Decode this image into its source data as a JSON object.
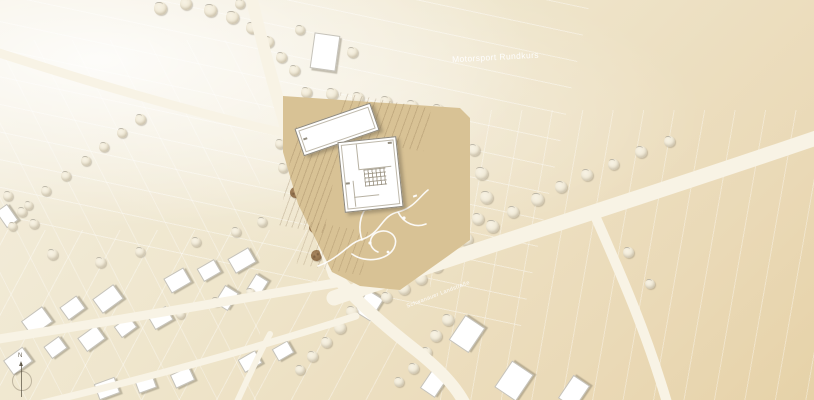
{
  "labels": {
    "area": "Motorsport Rundkurs",
    "street": "Schwanauer Landstraße",
    "north": "N"
  },
  "colors": {
    "background": "#efe7d0",
    "road": "#f8f3e5",
    "site": "#d8c295",
    "tree_dark": "#916f4a",
    "tree_light": "#f3edde",
    "house": "#ffffff",
    "shadow": "#8b8371",
    "label_text": "#ffffff"
  },
  "map": {
    "light_trees": [
      [
        160,
        8,
        13
      ],
      [
        186,
        4,
        12
      ],
      [
        210,
        10,
        13
      ],
      [
        232,
        17,
        13
      ],
      [
        252,
        28,
        12
      ],
      [
        268,
        42,
        12
      ],
      [
        281,
        57,
        11
      ],
      [
        240,
        4,
        10
      ],
      [
        294,
        70,
        11
      ],
      [
        300,
        30,
        10
      ],
      [
        352,
        52,
        11
      ],
      [
        140,
        119,
        11
      ],
      [
        122,
        133,
        10
      ],
      [
        104,
        147,
        10
      ],
      [
        86,
        161,
        10
      ],
      [
        66,
        176,
        10
      ],
      [
        46,
        191,
        10
      ],
      [
        28,
        205,
        9
      ],
      [
        8,
        196,
        10
      ],
      [
        22,
        212,
        10
      ],
      [
        12,
        226,
        9
      ],
      [
        34,
        224,
        10
      ],
      [
        306,
        92,
        11
      ],
      [
        332,
        94,
        12
      ],
      [
        358,
        98,
        12
      ],
      [
        386,
        102,
        12
      ],
      [
        412,
        106,
        12
      ],
      [
        438,
        110,
        12
      ],
      [
        286,
        120,
        10
      ],
      [
        280,
        144,
        10
      ],
      [
        283,
        168,
        10
      ],
      [
        474,
        150,
        12
      ],
      [
        481,
        173,
        13
      ],
      [
        486,
        197,
        13
      ],
      [
        478,
        219,
        12
      ],
      [
        466,
        239,
        13
      ],
      [
        452,
        255,
        12
      ],
      [
        437,
        267,
        12
      ],
      [
        421,
        279,
        12
      ],
      [
        404,
        289,
        12
      ],
      [
        386,
        297,
        11
      ],
      [
        492,
        226,
        13
      ],
      [
        513,
        212,
        12
      ],
      [
        537,
        199,
        13
      ],
      [
        561,
        187,
        12
      ],
      [
        587,
        175,
        12
      ],
      [
        613,
        164,
        11
      ],
      [
        641,
        152,
        12
      ],
      [
        669,
        141,
        11
      ],
      [
        352,
        312,
        12
      ],
      [
        340,
        328,
        12
      ],
      [
        326,
        342,
        11
      ],
      [
        312,
        356,
        11
      ],
      [
        300,
        370,
        10
      ],
      [
        448,
        320,
        12
      ],
      [
        436,
        336,
        12
      ],
      [
        426,
        352,
        11
      ],
      [
        413,
        368,
        11
      ],
      [
        399,
        382,
        10
      ],
      [
        52,
        254,
        11
      ],
      [
        100,
        262,
        11
      ],
      [
        140,
        252,
        10
      ],
      [
        196,
        242,
        10
      ],
      [
        236,
        232,
        10
      ],
      [
        262,
        222,
        10
      ],
      [
        216,
        302,
        10
      ],
      [
        250,
        292,
        9
      ],
      [
        180,
        314,
        9
      ],
      [
        628,
        252,
        11
      ],
      [
        650,
        284,
        10
      ]
    ],
    "dark_trees": [
      [
        378,
        126,
        10
      ],
      [
        355,
        142,
        9
      ],
      [
        376,
        138,
        10
      ],
      [
        341,
        158,
        10
      ],
      [
        320,
        156,
        11
      ],
      [
        305,
        173,
        12
      ],
      [
        327,
        182,
        10
      ],
      [
        295,
        192,
        11
      ],
      [
        418,
        138,
        11
      ],
      [
        433,
        158,
        11
      ],
      [
        400,
        162,
        12
      ],
      [
        409,
        183,
        12
      ],
      [
        393,
        212,
        11
      ],
      [
        424,
        198,
        10
      ],
      [
        430,
        210,
        11
      ],
      [
        411,
        224,
        11
      ],
      [
        436,
        232,
        10
      ],
      [
        396,
        235,
        11
      ],
      [
        407,
        250,
        11
      ],
      [
        324,
        208,
        13
      ],
      [
        345,
        216,
        11
      ],
      [
        315,
        227,
        12
      ],
      [
        349,
        238,
        12
      ],
      [
        365,
        243,
        12
      ],
      [
        331,
        249,
        13
      ],
      [
        368,
        259,
        12
      ],
      [
        348,
        267,
        12
      ],
      [
        378,
        268,
        10
      ],
      [
        316,
        255,
        11
      ],
      [
        361,
        276,
        11
      ],
      [
        325,
        191,
        11
      ]
    ],
    "houses": [
      {
        "x": 312,
        "y": 34,
        "w": 24,
        "h": 34,
        "r": 8
      },
      {
        "x": 0,
        "y": 206,
        "w": 12,
        "h": 18,
        "r": -35
      },
      {
        "x": 24,
        "y": 312,
        "w": 24,
        "h": 17,
        "r": -36
      },
      {
        "x": 62,
        "y": 300,
        "w": 19,
        "h": 14,
        "r": -36
      },
      {
        "x": 95,
        "y": 290,
        "w": 24,
        "h": 16,
        "r": -36
      },
      {
        "x": 166,
        "y": 272,
        "w": 21,
        "h": 15,
        "r": -30
      },
      {
        "x": 199,
        "y": 263,
        "w": 18,
        "h": 13,
        "r": -30
      },
      {
        "x": 230,
        "y": 252,
        "w": 22,
        "h": 15,
        "r": -30
      },
      {
        "x": 6,
        "y": 352,
        "w": 22,
        "h": 16,
        "r": -36
      },
      {
        "x": 46,
        "y": 340,
        "w": 17,
        "h": 13,
        "r": -36
      },
      {
        "x": 80,
        "y": 330,
        "w": 21,
        "h": 15,
        "r": -36
      },
      {
        "x": 116,
        "y": 320,
        "w": 17,
        "h": 12,
        "r": -36
      },
      {
        "x": 150,
        "y": 310,
        "w": 19,
        "h": 14,
        "r": -30
      },
      {
        "x": 216,
        "y": 290,
        "w": 19,
        "h": 14,
        "r": -58
      },
      {
        "x": 248,
        "y": 278,
        "w": 17,
        "h": 13,
        "r": -58
      },
      {
        "x": 96,
        "y": 380,
        "w": 20,
        "h": 15,
        "r": -20
      },
      {
        "x": 136,
        "y": 376,
        "w": 17,
        "h": 13,
        "r": -20
      },
      {
        "x": 172,
        "y": 370,
        "w": 19,
        "h": 13,
        "r": -25
      },
      {
        "x": 240,
        "y": 354,
        "w": 18,
        "h": 13,
        "r": -30
      },
      {
        "x": 274,
        "y": 344,
        "w": 16,
        "h": 12,
        "r": -30
      },
      {
        "x": 356,
        "y": 296,
        "w": 24,
        "h": 17,
        "r": -58
      },
      {
        "x": 452,
        "y": 322,
        "w": 28,
        "h": 22,
        "r": -56
      },
      {
        "x": 498,
        "y": 368,
        "w": 30,
        "h": 24,
        "r": -56
      },
      {
        "x": 560,
        "y": 382,
        "w": 26,
        "h": 18,
        "r": -56
      },
      {
        "x": 422,
        "y": 374,
        "w": 22,
        "h": 16,
        "r": -56
      }
    ]
  }
}
